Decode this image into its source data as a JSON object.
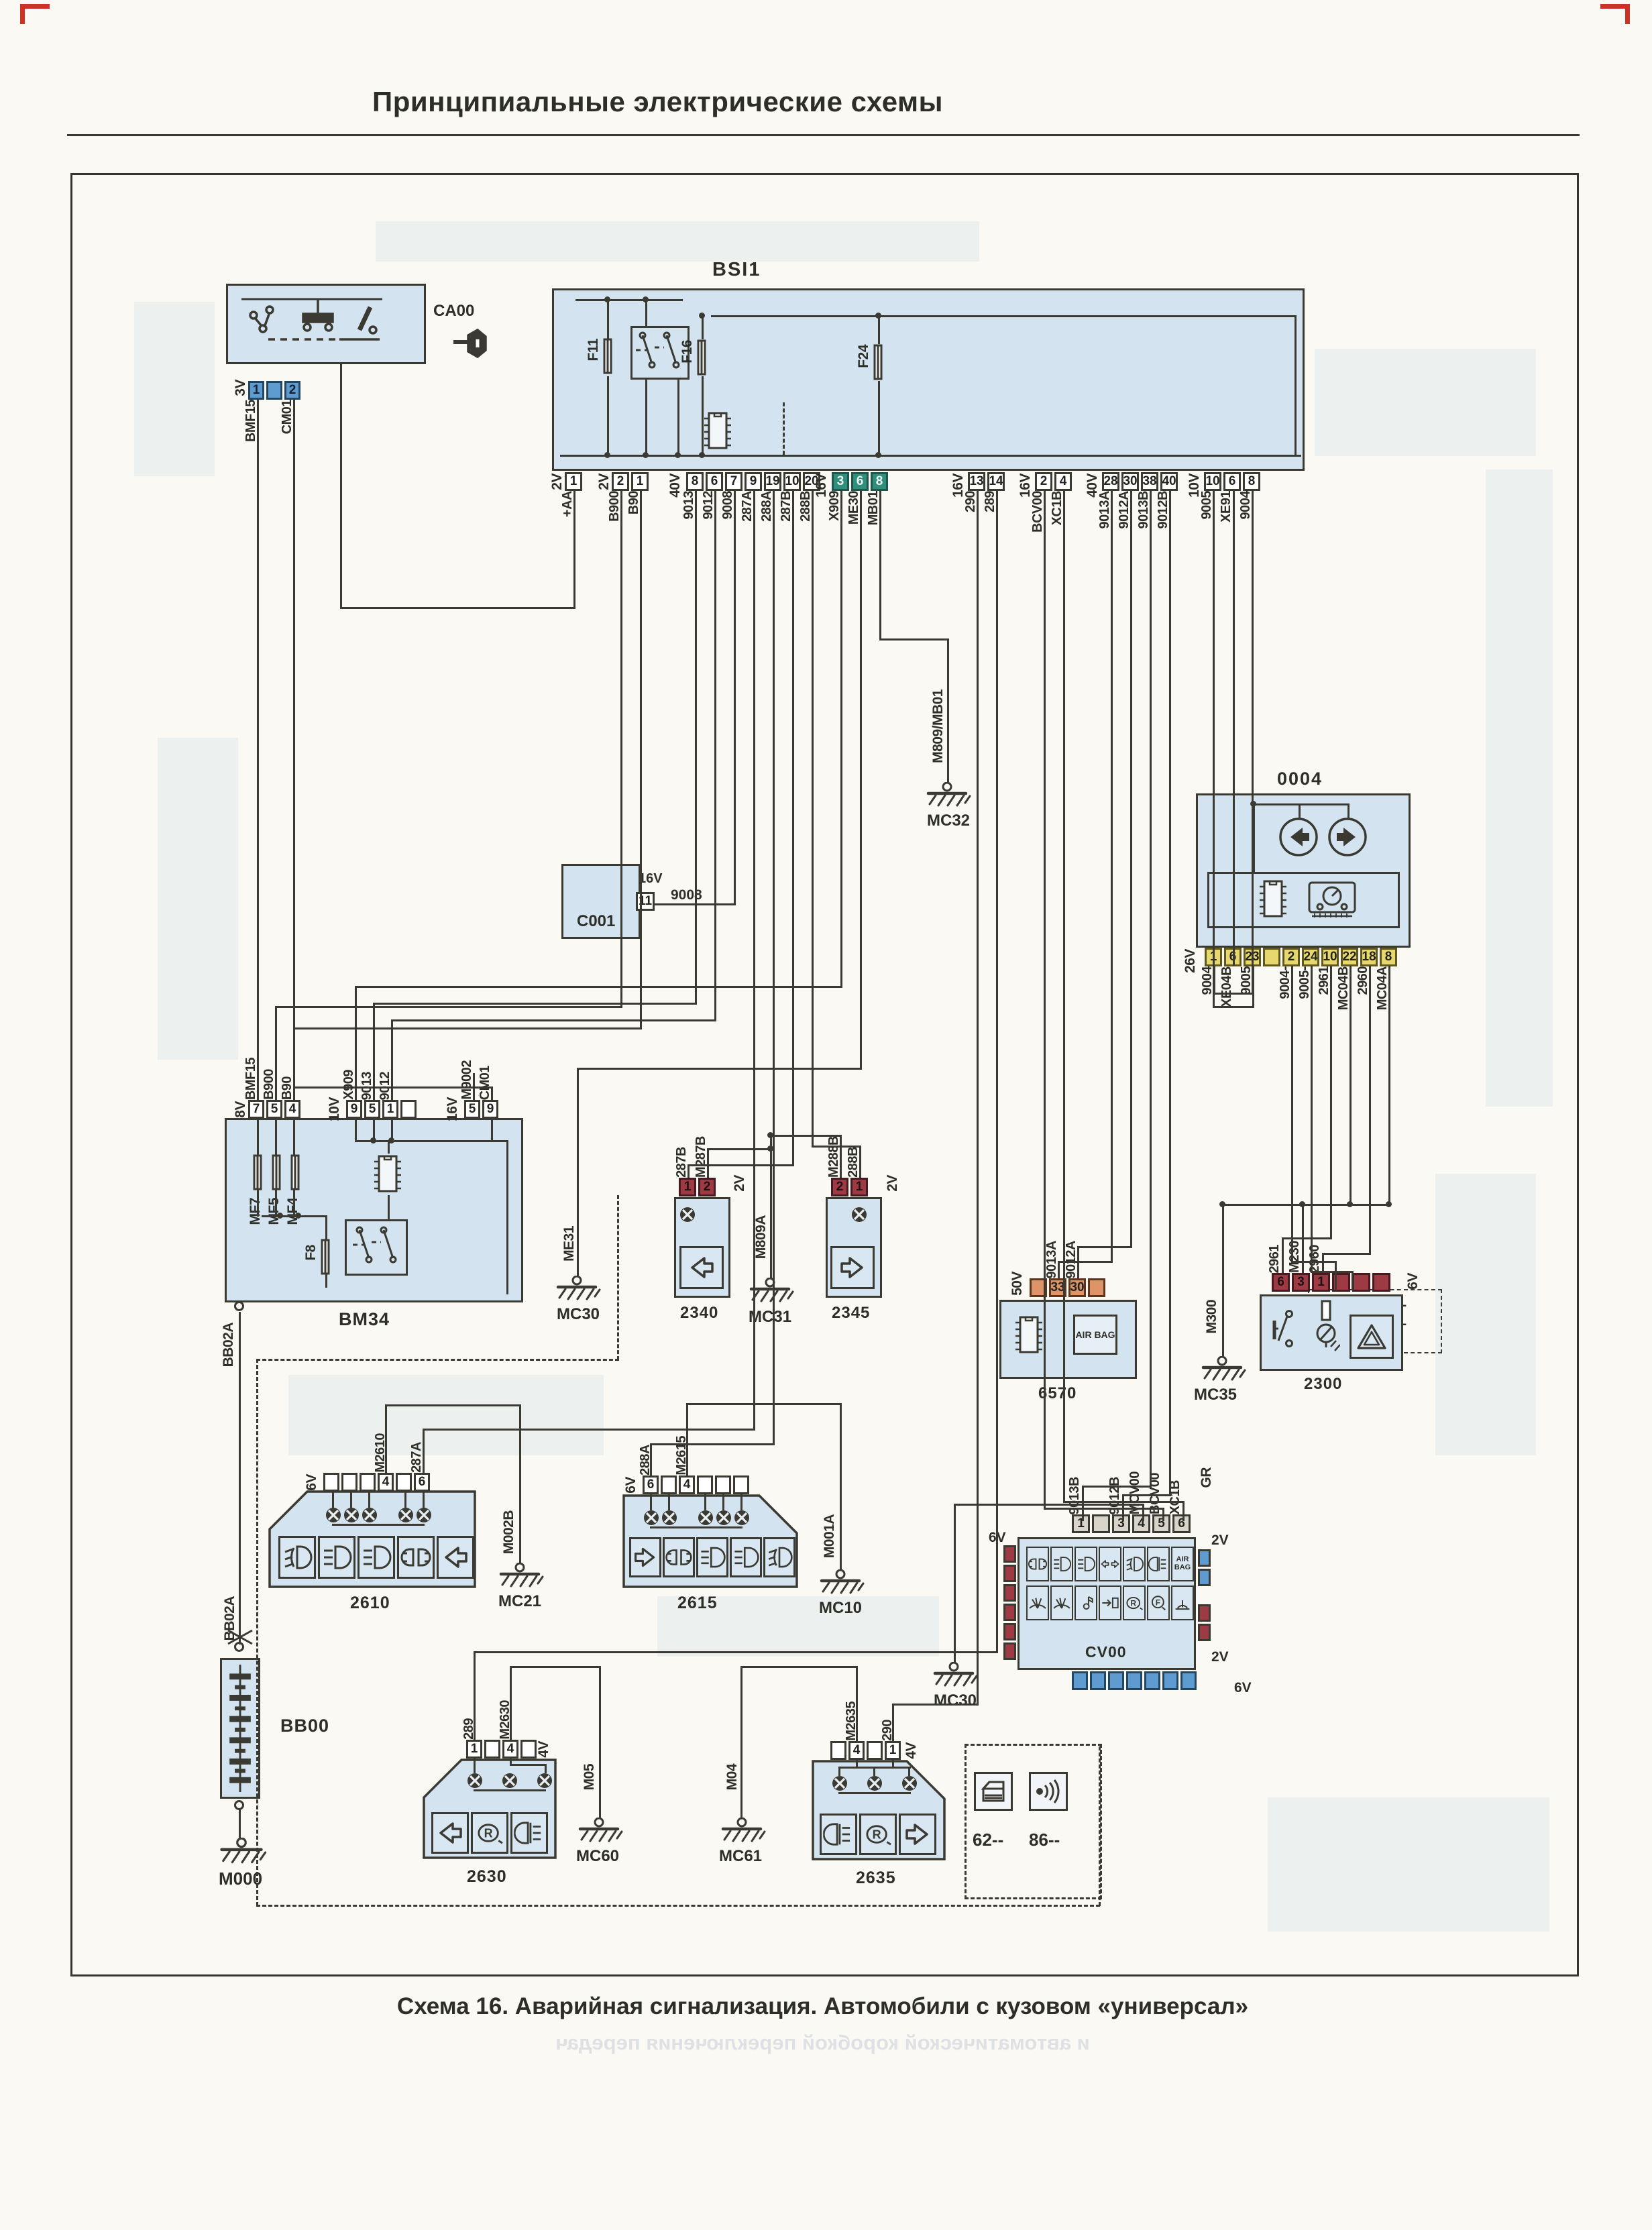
{
  "page": {
    "title": "Принципиальные электрические схемы",
    "caption": "Схема 16. Аварийная сигнализация. Автомобили с кузовом «универсал»",
    "ghost_caption": "и автоматической коробкой переключения передач"
  },
  "colors": {
    "block_fill": "#d3e4f0",
    "line": "#3a3a33",
    "green": "#2f8e7c",
    "yellow": "#e7d76f",
    "red": "#9e3a44",
    "orange": "#dd9468",
    "blue": "#5d9bd0"
  },
  "ignition": {
    "device": "CA00",
    "conn": {
      "type": "3V",
      "pins": [
        "1",
        "",
        "2"
      ],
      "wires": [
        "BMF15",
        "",
        "CM01"
      ]
    },
    "extra_wire": "+AA"
  },
  "bsi": {
    "label": "BSI1",
    "fuse_f11": "F11",
    "fuse_f16": "F16",
    "fuse_f24": "F24",
    "connectors": [
      {
        "type": "2V",
        "pins": [
          "1"
        ],
        "wires": [
          "+AA"
        ]
      },
      {
        "type": "2V",
        "pins": [
          "2",
          "1"
        ],
        "wires": [
          "B900",
          "B90"
        ]
      },
      {
        "type": "40V",
        "pins": [
          "8",
          "6",
          "7",
          "9",
          "19",
          "10",
          "20"
        ],
        "wires": [
          "9013",
          "9012",
          "9008",
          "287A",
          "288A",
          "287B",
          "288B"
        ]
      },
      {
        "type": "16V",
        "pins": [
          "3",
          "6",
          "8"
        ],
        "wires": [
          "X909",
          "ME30",
          "MB01"
        ]
      },
      {
        "type": "16V",
        "pins": [
          "13",
          "14"
        ],
        "wires": [
          "290",
          "289"
        ]
      },
      {
        "type": "16V",
        "pins": [
          "2",
          "4"
        ],
        "wires": [
          "BCV00",
          "XC1B"
        ]
      },
      {
        "type": "40V",
        "pins": [
          "28",
          "30",
          "38",
          "40"
        ],
        "wires": [
          "9013A",
          "9012A",
          "9013B",
          "9012B"
        ]
      },
      {
        "type": "10V",
        "pins": [
          "10",
          "6",
          "8"
        ],
        "wires": [
          "9005",
          "XE91",
          "9004"
        ]
      }
    ]
  },
  "cluster": {
    "label": "0004",
    "conn": {
      "type": "26V",
      "pins": [
        "1",
        "6",
        "23",
        "",
        "2",
        "24",
        "10",
        "22",
        "18",
        "8"
      ],
      "wires": [
        "9004",
        "XE04B",
        "9005",
        "",
        "9004-",
        "9005-",
        "2961",
        "MC04B",
        "2960",
        "MC04A"
      ]
    }
  },
  "conn72": {
    "wire1": "9004-",
    "wire2": "9005-",
    "label": "72--"
  },
  "c001": {
    "label": "C001",
    "conn_type": "16V",
    "pin": "11",
    "wire": "9008"
  },
  "bm34": {
    "label": "BM34",
    "fuse1": "MF7",
    "fuse2": "MF5",
    "fuse3": "MF4",
    "fuse_f8": "F8",
    "bottom_wire": "BB02A",
    "connectors": [
      {
        "type": "8V",
        "pins": [
          "7",
          "5",
          "4"
        ],
        "wires": [
          "BMF15",
          "B900",
          "B90"
        ]
      },
      {
        "type": "10V",
        "pins": [
          "9",
          "5",
          "1",
          ""
        ],
        "wires": [
          "X909",
          "9013",
          "9012",
          ""
        ]
      },
      {
        "type": "16V",
        "pins": [
          "5",
          "9"
        ],
        "wires": [
          "M9002",
          "CM01"
        ]
      }
    ]
  },
  "lamp2340": {
    "label": "2340",
    "conn_type": "2V",
    "pins": [
      "1",
      "2"
    ],
    "wires": [
      "287B",
      "M287B"
    ]
  },
  "lamp2345": {
    "label": "2345",
    "conn_type": "2V",
    "pins": [
      "2",
      "1"
    ],
    "wires": [
      "M288B",
      "288B"
    ]
  },
  "unit6570": {
    "label": "6570",
    "airbag": "AIR BAG",
    "conn_type": "50V",
    "pins": [
      "",
      "33",
      "30",
      ""
    ],
    "wires": [
      "",
      "9013A",
      "9012A",
      ""
    ]
  },
  "sw2300": {
    "label": "2300",
    "conn_type": "6V",
    "pins": [
      "6",
      "3",
      "1",
      "",
      "",
      ""
    ],
    "wires": [
      "2961",
      "M230",
      "2960",
      "",
      "",
      ""
    ]
  },
  "lamp2610": {
    "label": "2610",
    "conn_type": "6V",
    "pins": [
      "",
      "",
      "",
      "4",
      "",
      "6"
    ],
    "wires": [
      "",
      "",
      "",
      "M2610",
      "",
      "287A"
    ]
  },
  "lamp2615": {
    "label": "2615",
    "conn_type": "6V",
    "pins": [
      "6",
      "",
      "4",
      "",
      "",
      ""
    ],
    "wires": [
      "288A",
      "",
      "M2615",
      "",
      "",
      ""
    ]
  },
  "cv00": {
    "label": "CV00",
    "gr": "GR",
    "airbag": "AIR BAG",
    "top_pins": [
      "1",
      "",
      "3",
      "4",
      "5",
      "6"
    ],
    "top_wires": [
      "9013B",
      "",
      "9012B",
      "MCV00",
      "BCV00",
      "XC1B"
    ],
    "left_type": "6V",
    "right_top_type": "2V",
    "right_bottom_type": "2V",
    "bottom_type": "6V",
    "left_cells": [
      "",
      "",
      "",
      "",
      "",
      ""
    ],
    "rt_cells": [
      "",
      ""
    ],
    "rb_cells": [
      "",
      ""
    ],
    "bottom_cells": [
      "",
      "",
      "",
      "",
      "",
      "",
      ""
    ]
  },
  "lamp2630": {
    "label": "2630",
    "conn_type": "4V",
    "pins": [
      "1",
      "",
      "4",
      ""
    ],
    "wires": [
      "289",
      "",
      "M2630",
      ""
    ]
  },
  "lamp2635": {
    "label": "2635",
    "conn_type": "4V",
    "pins": [
      "",
      "4",
      "",
      "1"
    ],
    "wires": [
      "",
      "M2635",
      "",
      "290"
    ]
  },
  "legend": {
    "item1": "62--",
    "item2": "86--"
  },
  "bb00": {
    "label": "BB00",
    "wire_top": "BB02A",
    "wire_mid": "BB02A"
  },
  "grounds": {
    "mc32": "MC32",
    "mc32_wire": "M809/MB01",
    "mc30l": "MC30",
    "mc30l_wire": "ME31",
    "mc31": "MC31",
    "mc31_wire": "M809A",
    "mc35": "MC35",
    "mc35_wire": "M300",
    "mc21": "MC21",
    "mc21_wire": "M002B",
    "mc10": "MC10",
    "mc10_wire": "M001A",
    "mc30cv": "MC30",
    "mc60": "MC60",
    "mc60_wire": "M05",
    "mc61": "MC61",
    "mc61_wire": "M04",
    "m000": "M000"
  }
}
